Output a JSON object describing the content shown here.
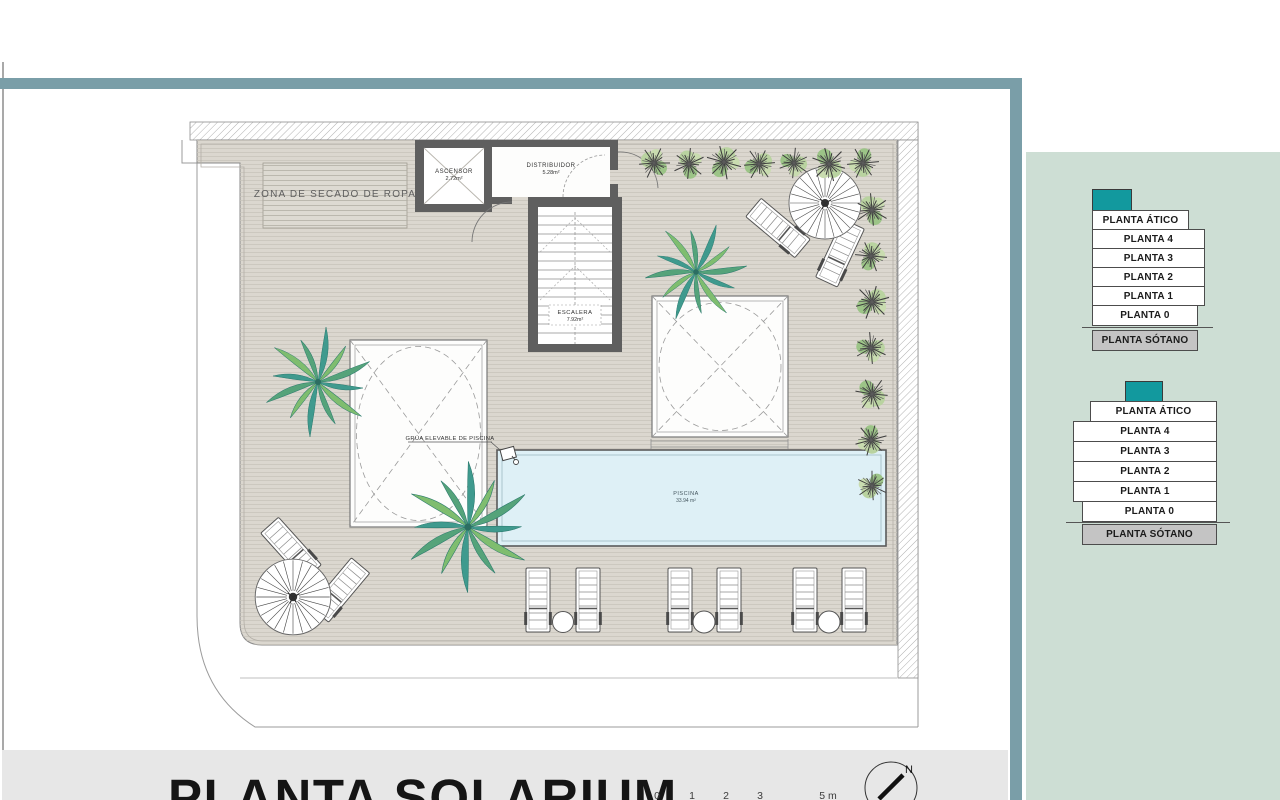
{
  "colors": {
    "accent_teal_border": "#7a9ea8",
    "sidebar_green": "#cdded4",
    "floor_highlight_teal": "#12999e",
    "basement_gray": "#c4c4c4",
    "deck_beige": "#dbd7cf",
    "pool_blue": "#def0f6",
    "footer_gray": "#e7e7e7",
    "wall_dark": "#5f5f5f"
  },
  "plan": {
    "zona_secado": "ZONA DE SECADO DE ROPA",
    "ascensor": {
      "label": "ASCENSOR",
      "area": "2.72m²"
    },
    "distribuidor": {
      "label": "DISTRIBUIDOR",
      "area": "5.28m²"
    },
    "escalera": {
      "label": "ESCALERA",
      "area": "7.92m²"
    },
    "piscina": {
      "label": "PISCINA",
      "area": "33.94 m²"
    },
    "grua": "GRÚA ELEVABLE DE PISCINA"
  },
  "footer": {
    "title": "PLANTA SOLARIUM",
    "scale_ticks": [
      "0",
      "1",
      "2",
      "3",
      "5 m"
    ],
    "north_label": "N"
  },
  "sidebar": {
    "stack_top": {
      "floors": [
        "PLANTA ÁTICO",
        "PLANTA 4",
        "PLANTA 3",
        "PLANTA 2",
        "PLANTA 1",
        "PLANTA 0",
        "PLANTA SÓTANO"
      ]
    },
    "stack_bottom": {
      "floors": [
        "PLANTA ÁTICO",
        "PLANTA 4",
        "PLANTA 3",
        "PLANTA 2",
        "PLANTA 1",
        "PLANTA 0",
        "PLANTA SÓTANO"
      ]
    }
  }
}
